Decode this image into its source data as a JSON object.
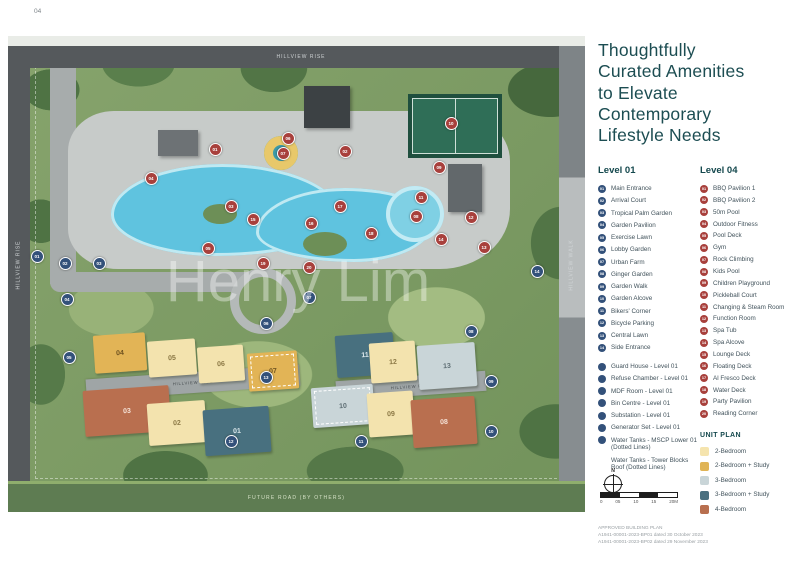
{
  "page": {
    "num_left": "04",
    "num_right": "05"
  },
  "panel": {
    "title_lines": [
      "Thoughtfully",
      "Curated Amenities",
      "to Elevate",
      "Contemporary",
      "Lifestyle Needs"
    ],
    "level01_heading": "Level 01",
    "level04_heading": "Level 04",
    "level01_items": [
      {
        "num": "01",
        "label": "Main Entrance"
      },
      {
        "num": "02",
        "label": "Arrival Court"
      },
      {
        "num": "03",
        "label": "Tropical Palm Garden"
      },
      {
        "num": "04",
        "label": "Garden Pavilion"
      },
      {
        "num": "05",
        "label": "Exercise Lawn"
      },
      {
        "num": "06",
        "label": "Lobby Garden"
      },
      {
        "num": "07",
        "label": "Urban Farm"
      },
      {
        "num": "08",
        "label": "Ginger Garden"
      },
      {
        "num": "09",
        "label": "Garden Walk"
      },
      {
        "num": "10",
        "label": "Garden Alcove"
      },
      {
        "num": "11",
        "label": "Bikers' Corner"
      },
      {
        "num": "12",
        "label": "Bicycle Parking"
      },
      {
        "num": "13",
        "label": "Central Lawn"
      },
      {
        "num": "14",
        "label": "Side Entrance"
      }
    ],
    "facility_items": [
      {
        "num": "",
        "label": "Guard House - Level 01"
      },
      {
        "num": "",
        "label": "Refuse Chamber - Level 01"
      },
      {
        "num": "",
        "label": "MDF Room - Level 01"
      },
      {
        "num": "",
        "label": "Bin Centre - Level 01"
      },
      {
        "num": "",
        "label": "Substation - Level 01"
      },
      {
        "num": "",
        "label": "Generator Set - Level 01"
      },
      {
        "num": "",
        "label": "Water Tanks - MSCP Lower 01 (Dotted Lines)"
      },
      {
        "num": null,
        "label": "Water Tanks - Tower Blocks Roof (Dotted Lines)"
      }
    ],
    "level04_items": [
      {
        "num": "01",
        "label": "BBQ Pavilion 1"
      },
      {
        "num": "02",
        "label": "BBQ Pavilion 2"
      },
      {
        "num": "03",
        "label": "50m Pool"
      },
      {
        "num": "04",
        "label": "Outdoor Fitness"
      },
      {
        "num": "05",
        "label": "Pool Deck"
      },
      {
        "num": "06",
        "label": "Gym"
      },
      {
        "num": "07",
        "label": "Rock Climbing"
      },
      {
        "num": "08",
        "label": "Kids Pool"
      },
      {
        "num": "09",
        "label": "Children Playground"
      },
      {
        "num": "10",
        "label": "Pickleball Court"
      },
      {
        "num": "11",
        "label": "Changing & Steam Room"
      },
      {
        "num": "12",
        "label": "Function Room"
      },
      {
        "num": "13",
        "label": "Spa Tub"
      },
      {
        "num": "14",
        "label": "Spa Alcove"
      },
      {
        "num": "15",
        "label": "Lounge Deck"
      },
      {
        "num": "16",
        "label": "Floating Deck"
      },
      {
        "num": "17",
        "label": "Al Fresco Deck"
      },
      {
        "num": "18",
        "label": "Water Deck"
      },
      {
        "num": "19",
        "label": "Party Pavilion"
      },
      {
        "num": "20",
        "label": "Reading Corner"
      }
    ],
    "unit_plan_heading": "UNIT PLAN",
    "unit_plan_items": [
      {
        "label": "2-Bedroom",
        "color": "#F5E4AE"
      },
      {
        "label": "2-Bedroom + Study",
        "color": "#E0B456"
      },
      {
        "label": "3-Bedroom",
        "color": "#C9D5D8"
      },
      {
        "label": "3-Bedroom + Study",
        "color": "#4A7080"
      },
      {
        "label": "4-Bedroom",
        "color": "#B86F4F"
      }
    ],
    "compass_label": "N",
    "scale_ticks": [
      "0",
      "05",
      "10",
      "15",
      "20M"
    ],
    "approval_lines": [
      "APPROVED BUILDING PLAN",
      "A1941-00001-2023-BP01 dated 30 October 2023",
      "A1941-00001-2023-BP02 dated 29 November 2023"
    ]
  },
  "map": {
    "watermark": "Henry Lim",
    "road_top": "HILLVIEW RISE",
    "road_left": "HILLVIEW RISE",
    "road_right": "HILLVIEW WALK",
    "road_bottom": "FUTURE ROAD (BY OTHERS)",
    "road_internal_left": "HILLVIEW RISE",
    "road_internal_right": "HILLVIEW RISE",
    "blocks": [
      {
        "label": "04",
        "t": "2bs",
        "x": 86,
        "y": 298,
        "w": 52,
        "h": 38,
        "dashed": false
      },
      {
        "label": "05",
        "t": "2b",
        "x": 140,
        "y": 304,
        "w": 48,
        "h": 36,
        "dashed": false
      },
      {
        "label": "06",
        "t": "2b",
        "x": 190,
        "y": 310,
        "w": 46,
        "h": 36,
        "dashed": false
      },
      {
        "label": "07",
        "t": "2bs",
        "x": 240,
        "y": 316,
        "w": 50,
        "h": 38,
        "dashed": true
      },
      {
        "label": "03",
        "t": "4b",
        "x": 76,
        "y": 352,
        "w": 86,
        "h": 46,
        "dashed": false
      },
      {
        "label": "02",
        "t": "2b",
        "x": 140,
        "y": 366,
        "w": 58,
        "h": 42,
        "dashed": false
      },
      {
        "label": "01",
        "t": "3bs",
        "x": 196,
        "y": 372,
        "w": 66,
        "h": 46,
        "dashed": false
      },
      {
        "label": "11",
        "t": "3bs",
        "x": 328,
        "y": 298,
        "w": 58,
        "h": 42,
        "dashed": false
      },
      {
        "label": "12",
        "t": "2b",
        "x": 362,
        "y": 306,
        "w": 46,
        "h": 40,
        "dashed": false
      },
      {
        "label": "13",
        "t": "3b",
        "x": 410,
        "y": 308,
        "w": 58,
        "h": 44,
        "dashed": false
      },
      {
        "label": "10",
        "t": "3b",
        "x": 304,
        "y": 350,
        "w": 62,
        "h": 40,
        "dashed": true
      },
      {
        "label": "09",
        "t": "2b",
        "x": 360,
        "y": 356,
        "w": 46,
        "h": 44,
        "dashed": false
      },
      {
        "label": "08",
        "t": "4b",
        "x": 404,
        "y": 362,
        "w": 64,
        "h": 48,
        "dashed": false
      }
    ],
    "markers": [
      {
        "n": "01",
        "c": "red",
        "x": 206,
        "y": 112
      },
      {
        "n": "02",
        "c": "red",
        "x": 336,
        "y": 114
      },
      {
        "n": "03",
        "c": "red",
        "x": 222,
        "y": 169
      },
      {
        "n": "04",
        "c": "red",
        "x": 142,
        "y": 141
      },
      {
        "n": "05",
        "c": "red",
        "x": 199,
        "y": 211
      },
      {
        "n": "06",
        "c": "red",
        "x": 279,
        "y": 101
      },
      {
        "n": "07",
        "c": "red",
        "x": 274,
        "y": 116
      },
      {
        "n": "08",
        "c": "red",
        "x": 407,
        "y": 179
      },
      {
        "n": "09",
        "c": "red",
        "x": 430,
        "y": 130
      },
      {
        "n": "10",
        "c": "red",
        "x": 442,
        "y": 86
      },
      {
        "n": "11",
        "c": "red",
        "x": 412,
        "y": 160
      },
      {
        "n": "12",
        "c": "red",
        "x": 462,
        "y": 180
      },
      {
        "n": "13",
        "c": "red",
        "x": 475,
        "y": 210
      },
      {
        "n": "14",
        "c": "red",
        "x": 432,
        "y": 202
      },
      {
        "n": "15",
        "c": "red",
        "x": 244,
        "y": 182
      },
      {
        "n": "16",
        "c": "red",
        "x": 302,
        "y": 186
      },
      {
        "n": "17",
        "c": "red",
        "x": 331,
        "y": 169
      },
      {
        "n": "18",
        "c": "red",
        "x": 362,
        "y": 196
      },
      {
        "n": "19",
        "c": "red",
        "x": 254,
        "y": 226
      },
      {
        "n": "20",
        "c": "red",
        "x": 300,
        "y": 230
      },
      {
        "n": "01",
        "c": "navy",
        "x": 28,
        "y": 219
      },
      {
        "n": "02",
        "c": "navy",
        "x": 56,
        "y": 226
      },
      {
        "n": "03",
        "c": "navy",
        "x": 90,
        "y": 226
      },
      {
        "n": "04",
        "c": "navy",
        "x": 58,
        "y": 262
      },
      {
        "n": "05",
        "c": "navy",
        "x": 60,
        "y": 320
      },
      {
        "n": "06",
        "c": "navy",
        "x": 257,
        "y": 286
      },
      {
        "n": "07",
        "c": "navy",
        "x": 300,
        "y": 260
      },
      {
        "n": "08",
        "c": "navy",
        "x": 462,
        "y": 294
      },
      {
        "n": "09",
        "c": "navy",
        "x": 482,
        "y": 344
      },
      {
        "n": "10",
        "c": "navy",
        "x": 482,
        "y": 394
      },
      {
        "n": "11",
        "c": "navy",
        "x": 352,
        "y": 404
      },
      {
        "n": "12",
        "c": "navy",
        "x": 222,
        "y": 404
      },
      {
        "n": "13",
        "c": "navy",
        "x": 257,
        "y": 340
      },
      {
        "n": "14",
        "c": "navy",
        "x": 528,
        "y": 234
      }
    ]
  },
  "colors": {
    "accent_teal": "#1C4D52",
    "badge_navy": "#33517A",
    "badge_red": "#A8403C"
  }
}
